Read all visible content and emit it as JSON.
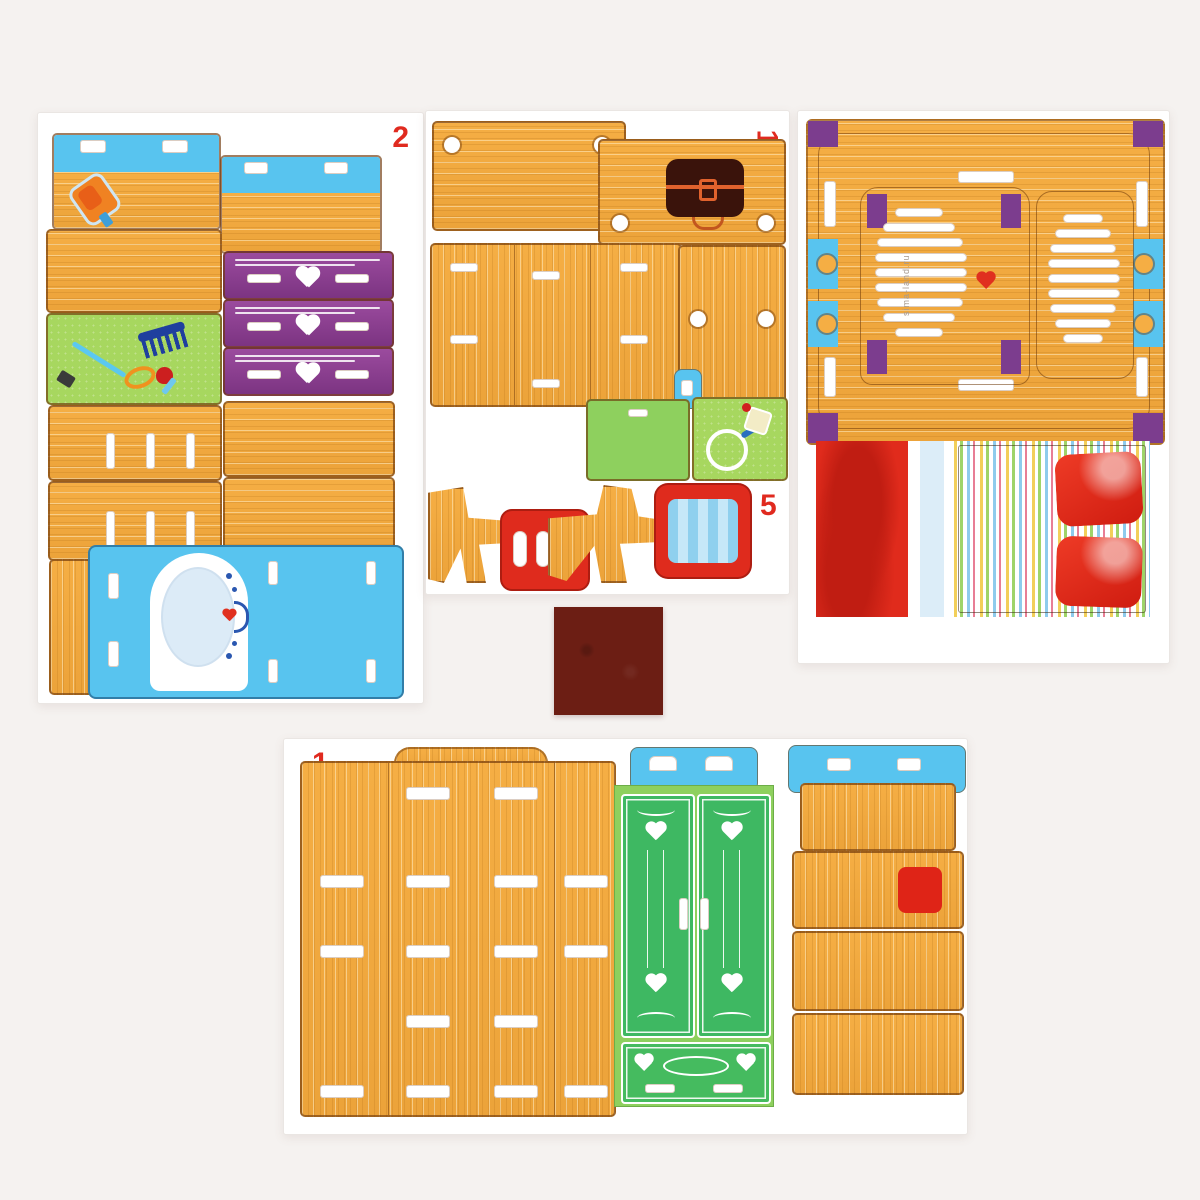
{
  "scene": {
    "description": "Product photo: punch-out cardboard sheets of a toy dollhouse bedroom furniture kit (wardrobe, vanity with mirror, chest of drawers, bed, chair) laid on a light background",
    "background_color": "#f5f2f0",
    "sheet_color": "#ffffff"
  },
  "labels": {
    "sheet2_number": "2",
    "middle_number_top": "1",
    "middle_number_mid": "4",
    "middle_number_bottom": "5",
    "sheet3_number": "3",
    "bottom_number": "1",
    "watermark": "sima-land.ru"
  },
  "palette": {
    "wood": "#f0a83e",
    "cut_line": "#6e380a",
    "blue_stock": "#58c4ef",
    "purple_stock": "#8c3f8e",
    "lime_pad": "#a7d75f",
    "wardrobe_light_green": "#8ed05e",
    "wardrobe_dark_green": "#3eb862",
    "red_stock": "#df2b1d",
    "number_red": "#e02a1f",
    "mirror_glass": "#dcebf7",
    "chest_brown": "#3a130b",
    "felt_square": "#6c1e14",
    "pillow_red": "#e0271a"
  }
}
